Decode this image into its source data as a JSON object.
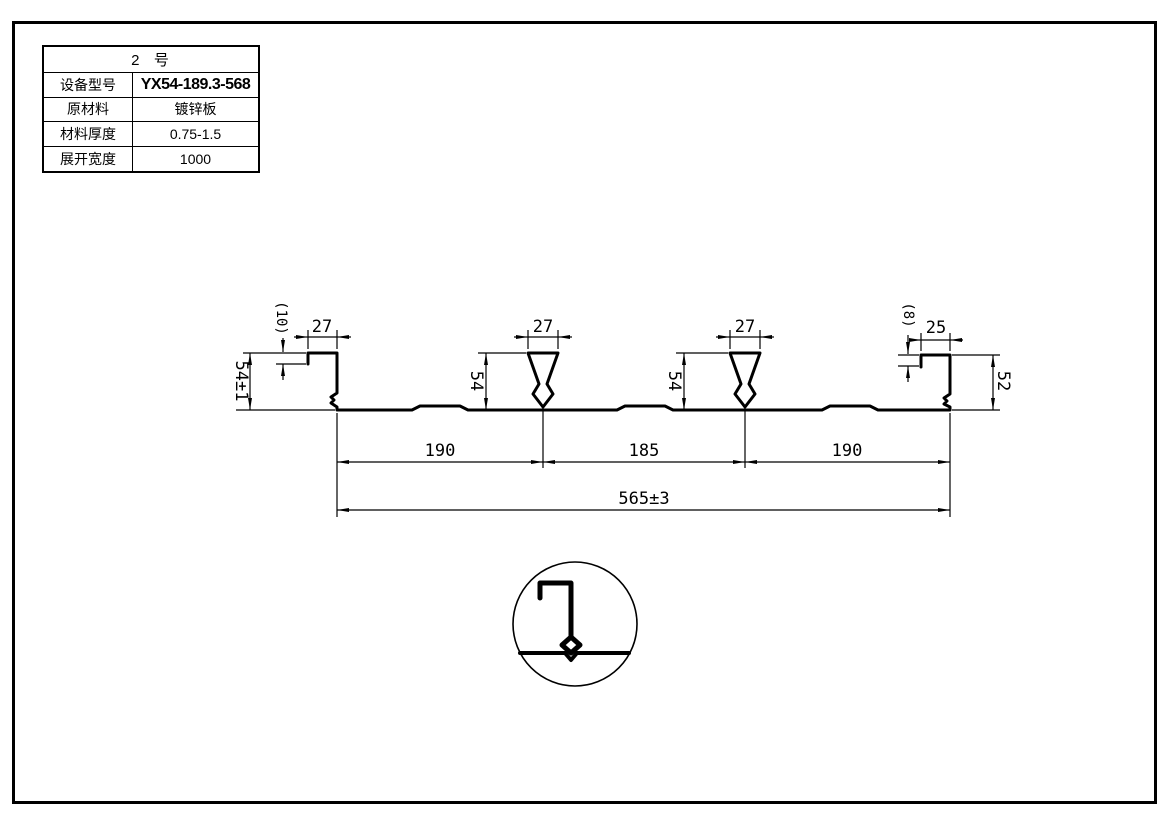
{
  "drawing": {
    "table": {
      "title": "2  号",
      "rows": [
        {
          "label": "设备型号",
          "value": "YX54-189.3-568"
        },
        {
          "label": "原材料",
          "value": "镀锌板"
        },
        {
          "label": "材料厚度",
          "value": "0.75-1.5"
        },
        {
          "label": "展开宽度",
          "value": "1000"
        }
      ]
    },
    "dims": {
      "left_hook_depth": "(10)",
      "left_lip_width": "27",
      "left_height": "54±1",
      "rib1_width": "27",
      "rib1_height": "54",
      "rib2_width": "27",
      "rib2_height": "54",
      "right_hook_depth": "(8)",
      "right_lip_width": "25",
      "right_height": "52",
      "pitch_left": "190",
      "pitch_mid": "185",
      "pitch_right": "190",
      "overall_width": "565±3"
    },
    "colors": {
      "ink": "#000000",
      "paper": "#ffffff"
    }
  }
}
